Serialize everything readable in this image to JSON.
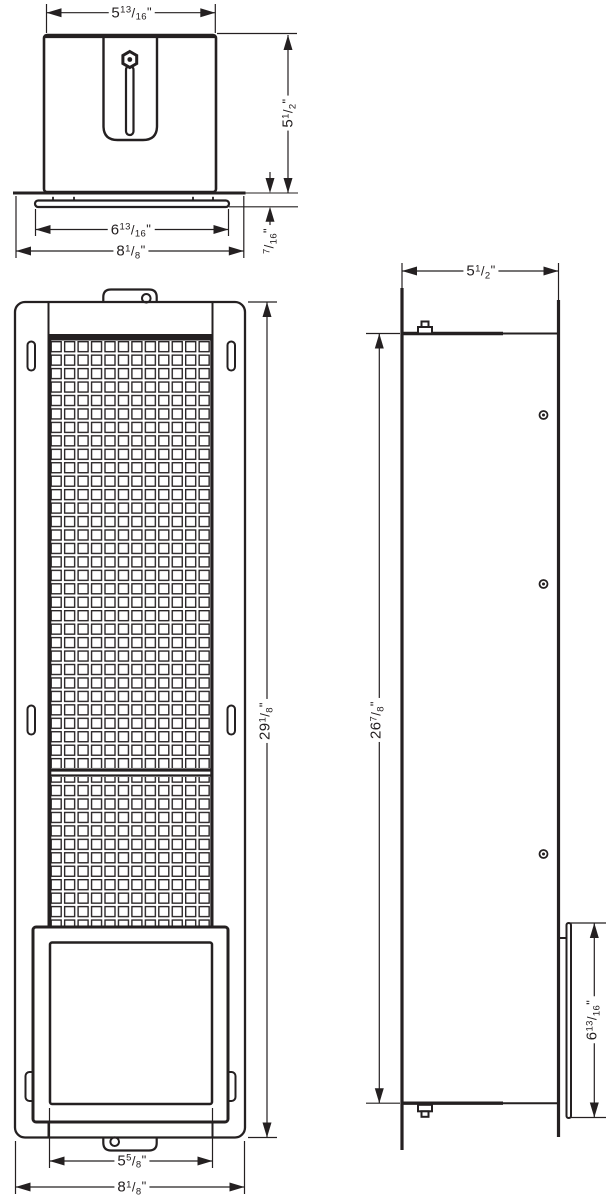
{
  "drawing": {
    "type": "installation-dimension-drawing",
    "views": [
      "top-view",
      "front-view",
      "side-view"
    ]
  },
  "colors": {
    "line": "#242021",
    "background": "#ffffff"
  },
  "glyphs": {
    "fraction_slash": "/"
  },
  "labels": {
    "top_view": {
      "width": {
        "whole": "5",
        "num": "13",
        "den": "16",
        "unit": "\""
      },
      "depth": {
        "whole": "5",
        "num": "1",
        "den": "2",
        "unit": "\""
      },
      "plate_width": {
        "whole": "6",
        "num": "13",
        "den": "16",
        "unit": "\""
      },
      "overall_width": {
        "whole": "8",
        "num": "1",
        "den": "8",
        "unit": "\""
      },
      "flange_thickness": {
        "whole": "",
        "num": "7",
        "den": "16",
        "unit": "\""
      }
    },
    "front_view": {
      "overall_height": {
        "whole": "29",
        "num": "1",
        "den": "8",
        "unit": "\""
      },
      "door_width": {
        "whole": "5",
        "num": "5",
        "den": "8",
        "unit": "\""
      },
      "overall_width": {
        "whole": "8",
        "num": "1",
        "den": "8",
        "unit": "\""
      }
    },
    "side_view": {
      "depth": {
        "whole": "5",
        "num": "1",
        "den": "2",
        "unit": "\""
      },
      "body_height": {
        "whole": "26",
        "num": "7",
        "den": "8",
        "unit": "\""
      },
      "door_height": {
        "whole": "6",
        "num": "13",
        "den": "16",
        "unit": "\""
      }
    }
  }
}
